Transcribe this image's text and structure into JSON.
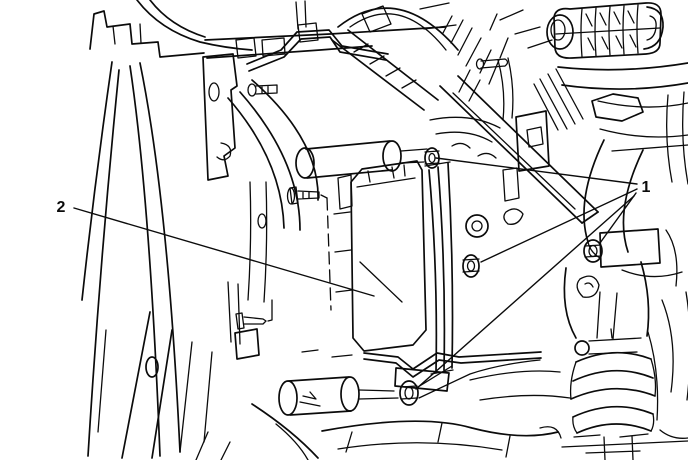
{
  "figure": {
    "background_color": "#ffffff",
    "line_color": "#0b0b0b",
    "callouts": [
      {
        "label": "1"
      },
      {
        "label": "2"
      }
    ]
  }
}
